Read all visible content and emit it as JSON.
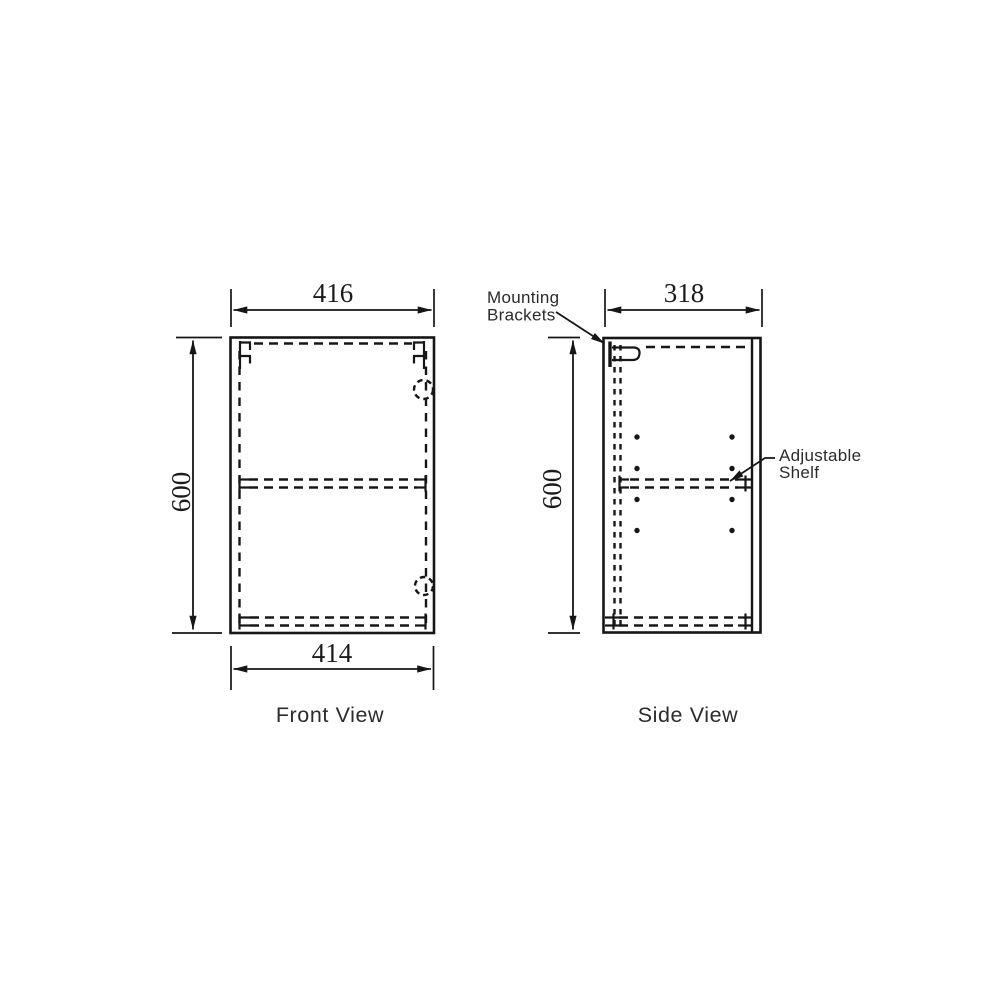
{
  "drawing": {
    "front_view": {
      "caption": "Front View",
      "top_width": "416",
      "bottom_width": "414",
      "height": "600"
    },
    "side_view": {
      "caption": "Side View",
      "depth": "318",
      "height": "600"
    },
    "annotations": {
      "mounting": {
        "line1": "Mounting",
        "line2": "Brackets"
      },
      "shelf": {
        "line1": "Adjustable",
        "line2": "Shelf"
      }
    },
    "colors": {
      "line": "#161616",
      "label": "#2b2b2b",
      "background": "#ffffff"
    }
  }
}
